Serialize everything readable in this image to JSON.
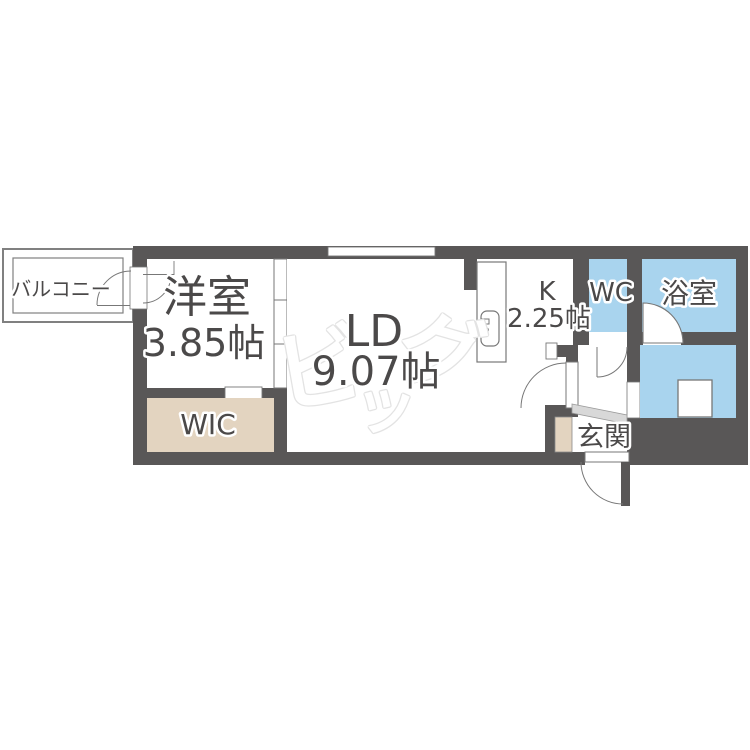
{
  "plan": {
    "balcony_label": "バルコニー",
    "western_room_label": "洋室",
    "western_room_size": "3.85帖",
    "ld_label": "LD",
    "ld_size": "9.07帖",
    "kitchen_label": "K",
    "kitchen_size": "2.25帖",
    "wc_label": "WC",
    "bath_label": "浴室",
    "wic_label": "WIC",
    "entrance_label": "玄関"
  },
  "watermark": {
    "char_1": "ビ",
    "char_2": "ッ",
    "char_3": "グ"
  },
  "colors": {
    "wall": "#595757",
    "wet": "#A9D4EE",
    "closet": "#E3D4C0",
    "step": "#D8D8D8",
    "line": "#777777",
    "label": "#4B4949",
    "wm": "#E3E3E3"
  }
}
